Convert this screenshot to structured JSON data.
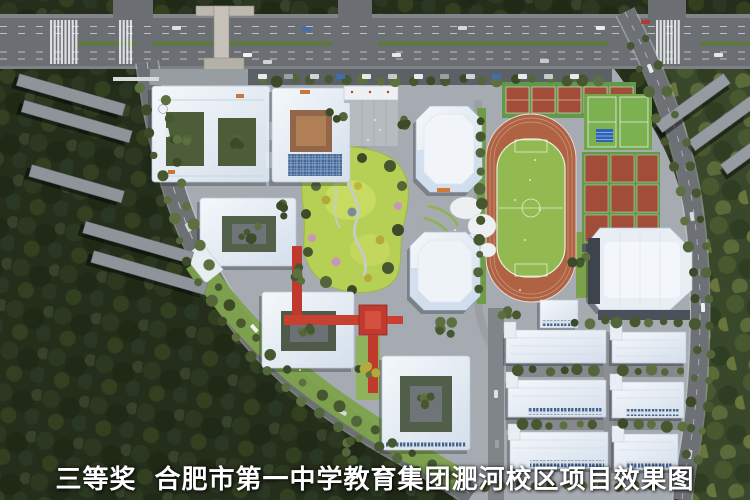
{
  "caption": {
    "award": "三等奖",
    "title": "合肥市第一中学教育集团淝河校区项目效果图"
  },
  "palette": {
    "forest_dark": "#242e1b",
    "forest_light": "#39482a",
    "road_gray": "#6b6f73",
    "campus_ground": "#a6abb1",
    "building_white": "#eef2f7",
    "roof_blue_tint": "#cfdded",
    "track_orange": "#b06343",
    "infield_green": "#92ba50",
    "court_red": "#a34c38",
    "court_green": "#5f9c49",
    "park_green": "#b6cf55",
    "skywalk_red": "#c03a2e",
    "median_green": "#5d7a3c",
    "atrium_brown": "#a8764f",
    "glass_blue": "#44689a",
    "caption_color": "#ffffff"
  }
}
